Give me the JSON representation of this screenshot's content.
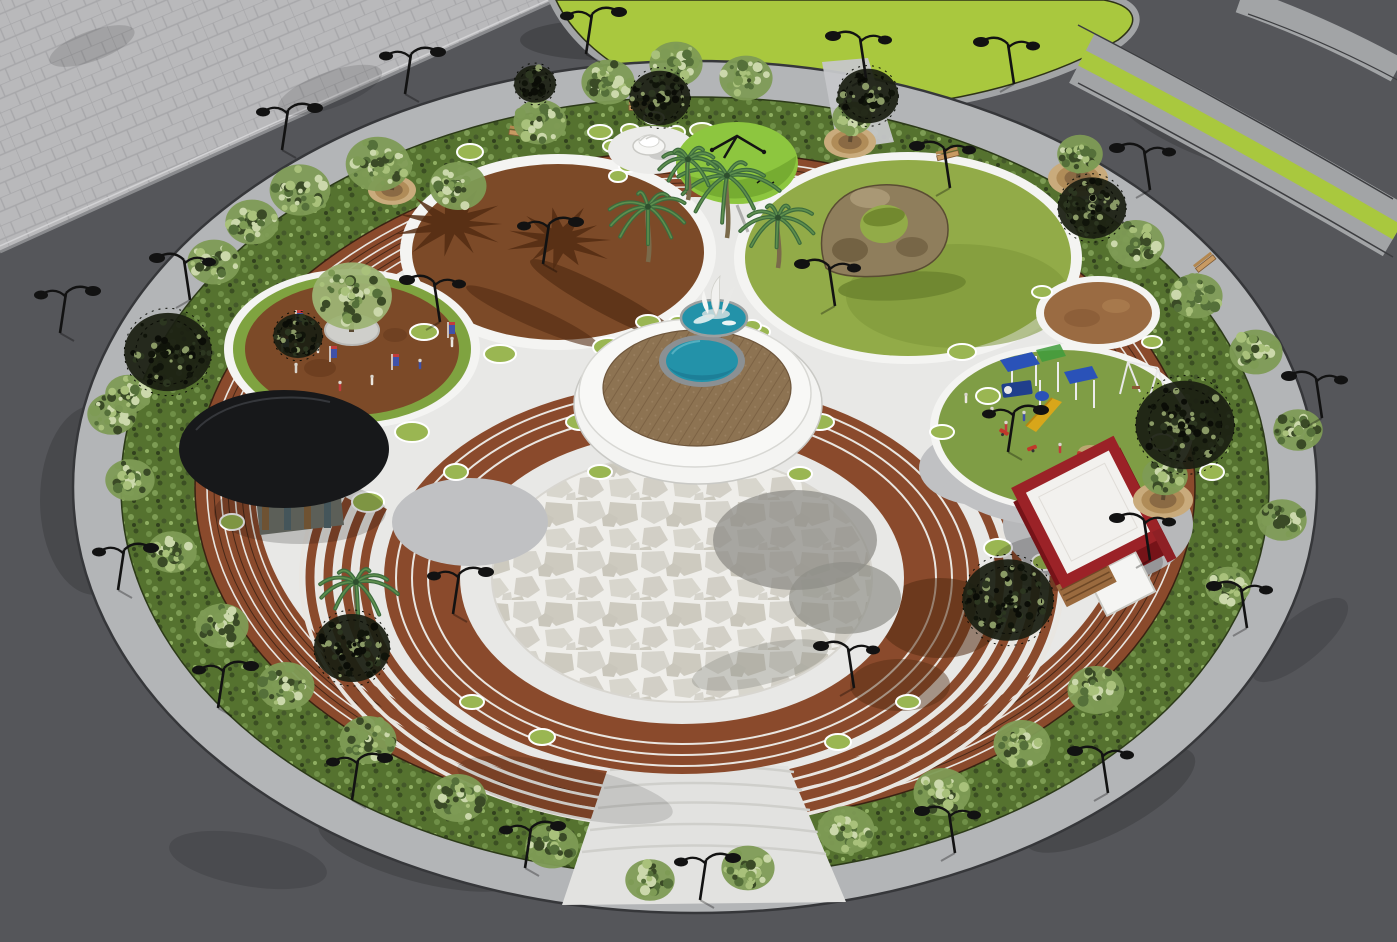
{
  "scene": {
    "type": "3d-architectural-render",
    "subject": "Aerial view of a circular landscaped public plaza with concentric seating rings, themed sub-circles, fountains, playground and kiosks, surrounded by roads"
  },
  "palette": {
    "asphalt": "#55565a",
    "paver": "#b9b9bb",
    "paver_line": "#a7a7aa",
    "curb": "#a2a4a6",
    "median_green": "#a9c83e",
    "sidewalk": "#b3b5b7",
    "hedge": "#55722f",
    "steps_brown": "#8a4a2c",
    "step_light": "#e9e6e1",
    "step_dark": "#472818",
    "plaza": "#e8e8e6",
    "circle_brown": "#7c4a28",
    "event_ring": "#7fa340",
    "lawn": "#92ab48",
    "play_lawn": "#7f9d45",
    "dot_green": "#9ab652",
    "stone": "#d6d4cc",
    "joint": "#efeeea",
    "platform": "#f4f4f2",
    "deck": "#8d7352",
    "pool": "#2392a9",
    "pool_rim": "#8b9093",
    "canopy_black": "#17181a",
    "canopy_lime": "#8dc63f",
    "lime_shade": "#6fa32e",
    "kiosk_red": "#8e2025",
    "kiosk_trim": "#9b2227",
    "kiosk_roof": "#f2f1ee",
    "kiosk_wood": "#9a6a3e",
    "rock": "#8f7e5c",
    "rock_dark": "#675739",
    "rock_light": "#b3a480",
    "palm_dark": "#3d6b3d",
    "palm_light": "#5e8f4e",
    "trunk": "#7a6a4a",
    "tree_base": "#7e9b55",
    "tree_light": "#a9c17b",
    "tree_pale": "#cbd8ab",
    "tree_deep": "#55703a",
    "dark_tree": "#1c2013",
    "lamp": "#121212",
    "bench": "#c89a62",
    "banner_blue": "#3f51a8",
    "banner_red": "#c23b3b",
    "play_blue": "#2a52b8",
    "play_navy": "#203f8c",
    "play_yellow": "#d8a61a",
    "play_green": "#3f9c3c",
    "play_red": "#c0392b",
    "shadow_brown": "#532c12",
    "stone_shadow": "#8f8e88",
    "entry": "#e2e2e0",
    "pad": "#c0c1c3"
  },
  "elements": {
    "park": "Circular park plaza",
    "central_pool": "Central round pool on raised deck platform",
    "sculpture_pool": "Sail sculpture pool",
    "grand_circle": "Flagstone amphitheater circle with brown step rings",
    "plaza_circle": "Brown paved circle with palm shadows",
    "event_circle": "Event circle with central tree, banners and people",
    "lawn_circle": "Lawn circle with rock arch sculpture",
    "playground": "Children playground circle",
    "black_canopy": "Round black canopy kiosk",
    "red_kiosk": "Red kiosk with white roof",
    "lime_canopy": "Lime-green umbrella canopy",
    "sculpture_pad": "Spiral fountain sculpture pad",
    "hedge": "Perimeter hedge ring with trees and lamps",
    "roads": "Surrounding asphalt roads",
    "paver_plaza": "Paved corner plaza",
    "median": "Planted road medians"
  }
}
